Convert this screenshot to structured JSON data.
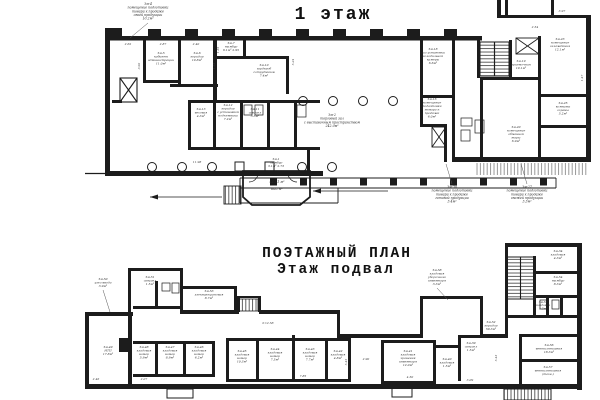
{
  "titles": {
    "floor1": "1 этаж",
    "plan_heading": "ПОЭТАЖНЫЙ ПЛАН",
    "basement": "Этаж подвал"
  },
  "colors": {
    "line": "#1c1c1c",
    "background": "#ffffff",
    "label": "#2b2b2b"
  },
  "plan_labels": [
    {
      "t": "Зм-4\nпомещение подготовки\nтовара к продаже\nсвоей продукции\n10.2м²",
      "x": 148,
      "y": 5,
      "s": 3.2
    },
    {
      "t": "Зм-5\nкабинет\nадминистрации\n11.0м²",
      "x": 161,
      "y": 54,
      "s": 3
    },
    {
      "t": "Зм-6\nкоридор\n10.8м²",
      "x": 197,
      "y": 54,
      "s": 3
    },
    {
      "t": "Зм-7\nтамбур\n6.1м²  2.95",
      "x": 231,
      "y": 44,
      "s": 3
    },
    {
      "t": "Зм-10\nгардероб\nсотрудников\n7.4м²",
      "x": 264,
      "y": 66,
      "s": 3
    },
    {
      "t": "Зм-2\nторговый зал\nс выставочным пространством\n242.0м²",
      "x": 332,
      "y": 116,
      "s": 3.2
    },
    {
      "t": "Зм-13\nвесовая\n4.3м²",
      "x": 201,
      "y": 110,
      "s": 3
    },
    {
      "t": "Зм-12\nкоридор\nс установкой\nподъемника\n7.2м²",
      "x": 228,
      "y": 106,
      "s": 3
    },
    {
      "t": "Зм-11\nсанузел\n3.3м²",
      "x": 255,
      "y": 110,
      "s": 3
    },
    {
      "t": "Зм-1\nтамбур\n3.1м²  2.73",
      "x": 276,
      "y": 160,
      "s": 3
    },
    {
      "t": "443.1 м²",
      "x": 277,
      "y": 183,
      "s": 3.4
    },
    {
      "t": "688 м²",
      "x": 277,
      "y": 190,
      "s": 3.4
    },
    {
      "t": "Зм-18\nзал установки\nхолодильной\nкамеры\n6.6м²",
      "x": 433,
      "y": 50,
      "s": 3
    },
    {
      "t": "Зм-16\nпомещение\nподготовки\nтовара к\nпродаже\n6.0м²",
      "x": 432,
      "y": 100,
      "s": 3
    },
    {
      "t": "Зм-19\nприемочная\n10.1м²",
      "x": 521,
      "y": 62,
      "s": 3
    },
    {
      "t": "Зм-23\nпомещение\nохлаждения\n12.1м²",
      "x": 560,
      "y": 40,
      "s": 3
    },
    {
      "t": "Зм-25\nкомната\nохраны\n5.2м²",
      "x": 563,
      "y": 104,
      "s": 3
    },
    {
      "t": "Зм-20\nпомещение\nобменной\nтары\n6.9м²",
      "x": 516,
      "y": 128,
      "s": 3
    },
    {
      "t": "Зм-30\nпомещение подготовки\nтовара к продаже\nготовой продукции\n3.4м²",
      "x": 452,
      "y": 188,
      "s": 3.2
    },
    {
      "t": "Зм-27\nпомещение подготовки\nтовара к продаже\nсвежей продукции\n3.3м²",
      "x": 527,
      "y": 188,
      "s": 3.2
    },
    {
      "t": "Зм-50\nузел ввода\n3.9м²",
      "x": 103,
      "y": 280,
      "s": 3
    },
    {
      "t": "Зм-51\nсанузел\n1.5м²",
      "x": 150,
      "y": 278,
      "s": 3
    },
    {
      "t": "Зм-53\nэлектрощитовая\n8.7м²",
      "x": 209,
      "y": 292,
      "s": 3
    },
    {
      "t": "Зм-58\nкладовая\nуборочного\nинвентаря\n3.3м²",
      "x": 437,
      "y": 271,
      "s": 3
    },
    {
      "t": "Зм-49\nИТП\n17.8м²",
      "x": 108,
      "y": 348,
      "s": 3
    },
    {
      "t": "Зм-48\nкладовая\nномер\n5.9м²",
      "x": 144,
      "y": 348,
      "s": 3
    },
    {
      "t": "Зм-47\nкладовая\nномер\n8.9м²",
      "x": 170,
      "y": 348,
      "s": 3
    },
    {
      "t": "Зм-46\nкладовая\nномер\n6.2м²",
      "x": 199,
      "y": 348,
      "s": 3
    },
    {
      "t": "Зм-45\nкладовая\nномер\n10.3м²",
      "x": 242,
      "y": 352,
      "s": 3
    },
    {
      "t": "Зм-44\nкладовая\nномер\n7.5м²",
      "x": 275,
      "y": 350,
      "s": 3
    },
    {
      "t": "Зм-43\nкладовая\nномер\n7.7м²",
      "x": 310,
      "y": 350,
      "s": 3
    },
    {
      "t": "Зм-42\nкладовая\n4.8м²",
      "x": 338,
      "y": 352,
      "s": 3
    },
    {
      "t": "Зм-41\nкладовая\nхранения\nинвентаря\n12.0м²",
      "x": 408,
      "y": 352,
      "s": 3
    },
    {
      "t": "Зм-40\nкладовая\n1.5м²",
      "x": 447,
      "y": 360,
      "s": 3
    },
    {
      "t": "Зм-39\nсанузел\n1.5м²",
      "x": 471,
      "y": 344,
      "s": 3
    },
    {
      "t": "Зм-52\nкоридор\n59.3м²",
      "x": 491,
      "y": 323,
      "s": 3
    },
    {
      "t": "Зм-56\nвентиляторная\n18.3м²",
      "x": 549,
      "y": 346,
      "s": 3
    },
    {
      "t": "Зм-57\nвентиляторная\n(техн.)",
      "x": 548,
      "y": 368,
      "s": 3
    },
    {
      "t": "Зм-55\nкладовая\n1.2м²",
      "x": 543,
      "y": 303,
      "s": 2.8
    },
    {
      "t": "Зм-54\nтамбур\n8.3м²",
      "x": 558,
      "y": 278,
      "s": 3
    },
    {
      "t": "Зм-34\nкладовая\n4.3м²",
      "x": 558,
      "y": 252,
      "s": 3
    },
    {
      "t": "h=2.58",
      "x": 268,
      "y": 324,
      "s": 3,
      "k": "dim"
    },
    {
      "t": "2.62",
      "x": 128,
      "y": 45,
      "s": 3,
      "k": "dim"
    },
    {
      "t": "2.87",
      "x": 163,
      "y": 45,
      "s": 3,
      "k": "dim"
    },
    {
      "t": "2.40",
      "x": 196,
      "y": 45,
      "s": 3,
      "k": "dim"
    },
    {
      "t": "1.35",
      "x": 219,
      "y": 50,
      "s": 3,
      "k": "dim",
      "r": -90
    },
    {
      "t": "5.24",
      "x": 294,
      "y": 62,
      "s": 3,
      "k": "dim",
      "r": -90
    },
    {
      "t": "11.98",
      "x": 197,
      "y": 163,
      "s": 3,
      "k": "dim"
    },
    {
      "t": "2.54",
      "x": 535,
      "y": 28,
      "s": 3,
      "k": "dim"
    },
    {
      "t": "3.97",
      "x": 562,
      "y": 12,
      "s": 3,
      "k": "dim"
    },
    {
      "t": "1.47",
      "x": 583,
      "y": 78,
      "s": 3,
      "k": "dim",
      "r": -90
    },
    {
      "t": "1.33",
      "x": 215,
      "y": 66,
      "s": 3,
      "k": "dim",
      "r": -90
    },
    {
      "t": "5.45",
      "x": 347,
      "y": 362,
      "s": 3,
      "k": "dim",
      "r": -90
    },
    {
      "t": "2.90",
      "x": 366,
      "y": 360,
      "s": 3,
      "k": "dim"
    },
    {
      "t": "7.85",
      "x": 303,
      "y": 377,
      "s": 3,
      "k": "dim"
    },
    {
      "t": "2.46",
      "x": 96,
      "y": 380,
      "s": 3,
      "k": "dim"
    },
    {
      "t": "2.07",
      "x": 144,
      "y": 380,
      "s": 3,
      "k": "dim"
    },
    {
      "t": "4.50",
      "x": 410,
      "y": 378,
      "s": 3,
      "k": "dim"
    },
    {
      "t": "3.09",
      "x": 470,
      "y": 381,
      "s": 3,
      "k": "dim"
    },
    {
      "t": "5.43",
      "x": 497,
      "y": 358,
      "s": 3,
      "k": "dim",
      "r": -90
    },
    {
      "t": "3.92",
      "x": 140,
      "y": 66,
      "s": 3,
      "k": "dim",
      "r": -90
    }
  ]
}
